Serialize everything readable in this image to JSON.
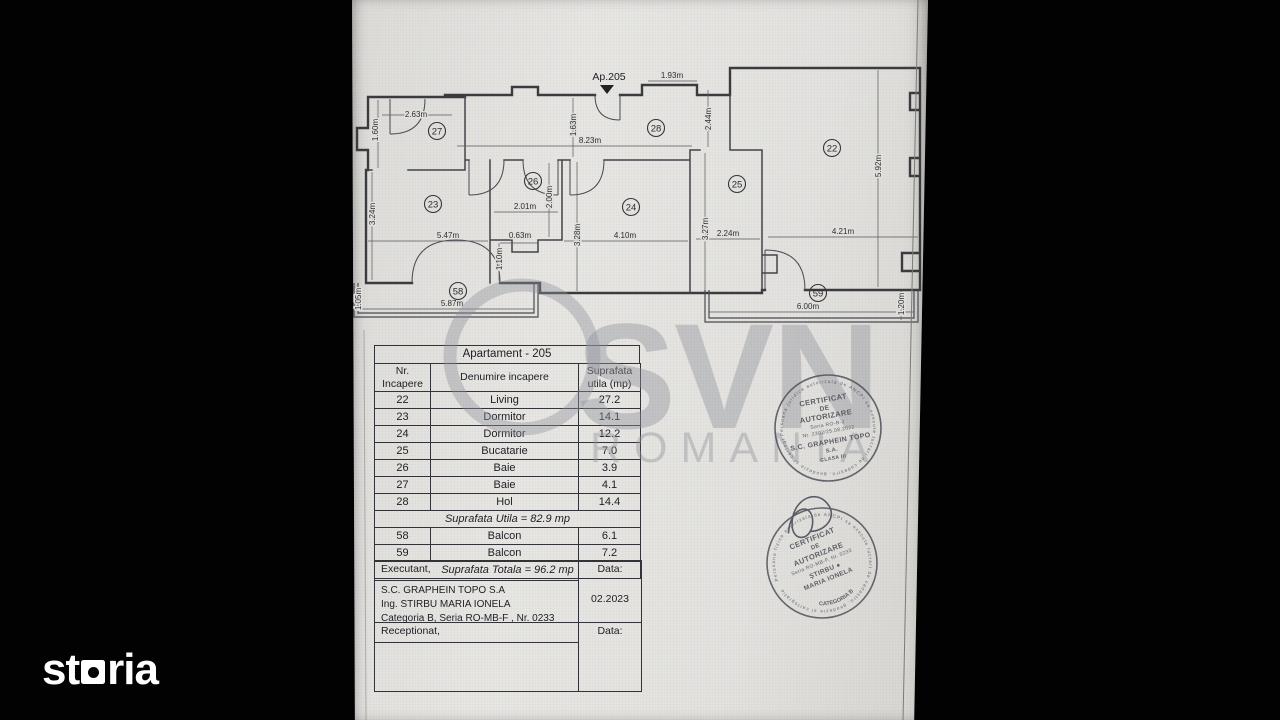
{
  "colors": {
    "background": "#000000",
    "paper": "#e3e2df",
    "line_ink": "#3c3c40",
    "stamp_ink": "#50505a",
    "watermark_gray": "#92949d",
    "logo_white": "#ffffff"
  },
  "brand": {
    "logo_text_part1": "st",
    "logo_text_part2": "ria"
  },
  "watermark": {
    "line1": "SVN",
    "line2": "ROMANIA"
  },
  "plan": {
    "apartment_label": "Ap.205",
    "room_labels": [
      {
        "id": "22",
        "x": 480,
        "y": 148
      },
      {
        "id": "23",
        "x": 81,
        "y": 204
      },
      {
        "id": "24",
        "x": 279,
        "y": 207
      },
      {
        "id": "25",
        "x": 385,
        "y": 184
      },
      {
        "id": "26",
        "x": 181,
        "y": 181
      },
      {
        "id": "27",
        "x": 85,
        "y": 131
      },
      {
        "id": "28",
        "x": 304,
        "y": 128
      },
      {
        "id": "58",
        "x": 106,
        "y": 291
      },
      {
        "id": "59",
        "x": 466,
        "y": 293
      }
    ],
    "dimensions": [
      {
        "text": "2.63m",
        "x": 64,
        "y": 117,
        "rot": 0
      },
      {
        "text": "1.60m",
        "x": 26,
        "y": 130,
        "rot": -90
      },
      {
        "text": "1.93m",
        "x": 320,
        "y": 78,
        "rot": 0
      },
      {
        "text": "2.44m",
        "x": 359,
        "y": 119,
        "rot": -90
      },
      {
        "text": "1.63m",
        "x": 224,
        "y": 125,
        "rot": -90
      },
      {
        "text": "8.23m",
        "x": 238,
        "y": 143,
        "rot": 0
      },
      {
        "text": "2.01m",
        "x": 173,
        "y": 209,
        "rot": 0
      },
      {
        "text": "2.00m",
        "x": 200,
        "y": 197,
        "rot": -90
      },
      {
        "text": "0.63m",
        "x": 168,
        "y": 238,
        "rot": 0
      },
      {
        "text": "1.10m",
        "x": 150,
        "y": 259,
        "rot": -90
      },
      {
        "text": "3.24m",
        "x": 23,
        "y": 214,
        "rot": -90
      },
      {
        "text": "5.47m",
        "x": 96,
        "y": 238,
        "rot": 0
      },
      {
        "text": "4.10m",
        "x": 273,
        "y": 238,
        "rot": 0
      },
      {
        "text": "3.28m",
        "x": 228,
        "y": 235,
        "rot": -90
      },
      {
        "text": "2.24m",
        "x": 376,
        "y": 236,
        "rot": 0
      },
      {
        "text": "3.27m",
        "x": 356,
        "y": 229,
        "rot": -90
      },
      {
        "text": "4.21m",
        "x": 491,
        "y": 234,
        "rot": 0
      },
      {
        "text": "5.92m",
        "x": 529,
        "y": 166,
        "rot": -90
      },
      {
        "text": "5.87m",
        "x": 100,
        "y": 306,
        "rot": 0
      },
      {
        "text": "1.05m",
        "x": 9,
        "y": 299,
        "rot": -90
      },
      {
        "text": "6.00m",
        "x": 456,
        "y": 309,
        "rot": 0
      },
      {
        "text": "1.20m",
        "x": 552,
        "y": 304,
        "rot": -90
      }
    ]
  },
  "table": {
    "title": "Apartament -  205",
    "col1_line1": "Nr.",
    "col1_line2": "Incapere",
    "col2": "Denumire incapere",
    "col3_line1": "Suprafata",
    "col3_line2": "utila (mp)",
    "rooms": [
      {
        "nr": "22",
        "name": "Living",
        "area": "27.2"
      },
      {
        "nr": "23",
        "name": "Dormitor",
        "area": "14.1"
      },
      {
        "nr": "24",
        "name": "Dormitor",
        "area": "12.2"
      },
      {
        "nr": "25",
        "name": "Bucatarie",
        "area": "7.0"
      },
      {
        "nr": "26",
        "name": "Baie",
        "area": "3.9"
      },
      {
        "nr": "27",
        "name": "Baie",
        "area": "4.1"
      },
      {
        "nr": "28",
        "name": "Hol",
        "area": "14.4"
      }
    ],
    "suprafata_utila": "Suprafata Utila =  82.9 mp",
    "balconies": [
      {
        "nr": "58",
        "name": "Balcon",
        "area": "6.1"
      },
      {
        "nr": "59",
        "name": "Balcon",
        "area": "7.2"
      }
    ],
    "suprafata_totala": "Suprafata Totala =  96.2 mp"
  },
  "signoff": {
    "executant_label": "Executant,",
    "data_label_1": "Data:",
    "executant_lines": [
      "S.C. GRAPHEIN TOPO S.A",
      "Ing. STIRBU MARIA IONELA",
      "Categoria B, Seria RO-MB-F , Nr. 0233"
    ],
    "date_value": "02.2023",
    "receptionat_label": "Receptionat,",
    "data_label_2": "Data:"
  },
  "stamps": [
    {
      "edge_text": "Persoana juridica autorizata de ANCPI sa execute lucrari de cadastru, geodezie si cartografie",
      "lines": [
        "CERTIFICAT",
        "DE",
        "AUTORIZARE",
        "Seria RO-B-J",
        "Nr. 2302/25.08.2022",
        "S.C. GRAPHEIN TOPO",
        "S.A.",
        "CLASA III"
      ]
    },
    {
      "edge_text": "Persoana fizica autorizata de ANCPI sa execute lucrari de cadastru, geodezie si cartografie",
      "lines": [
        "CERTIFICAT",
        "DE",
        "AUTORIZARE",
        "Seria RO-MB-F, Nr. 0233",
        "ŞTIRBU ●",
        "MARIA IONELA"
      ],
      "bottom_arc": "CATEGORIA B"
    }
  ]
}
